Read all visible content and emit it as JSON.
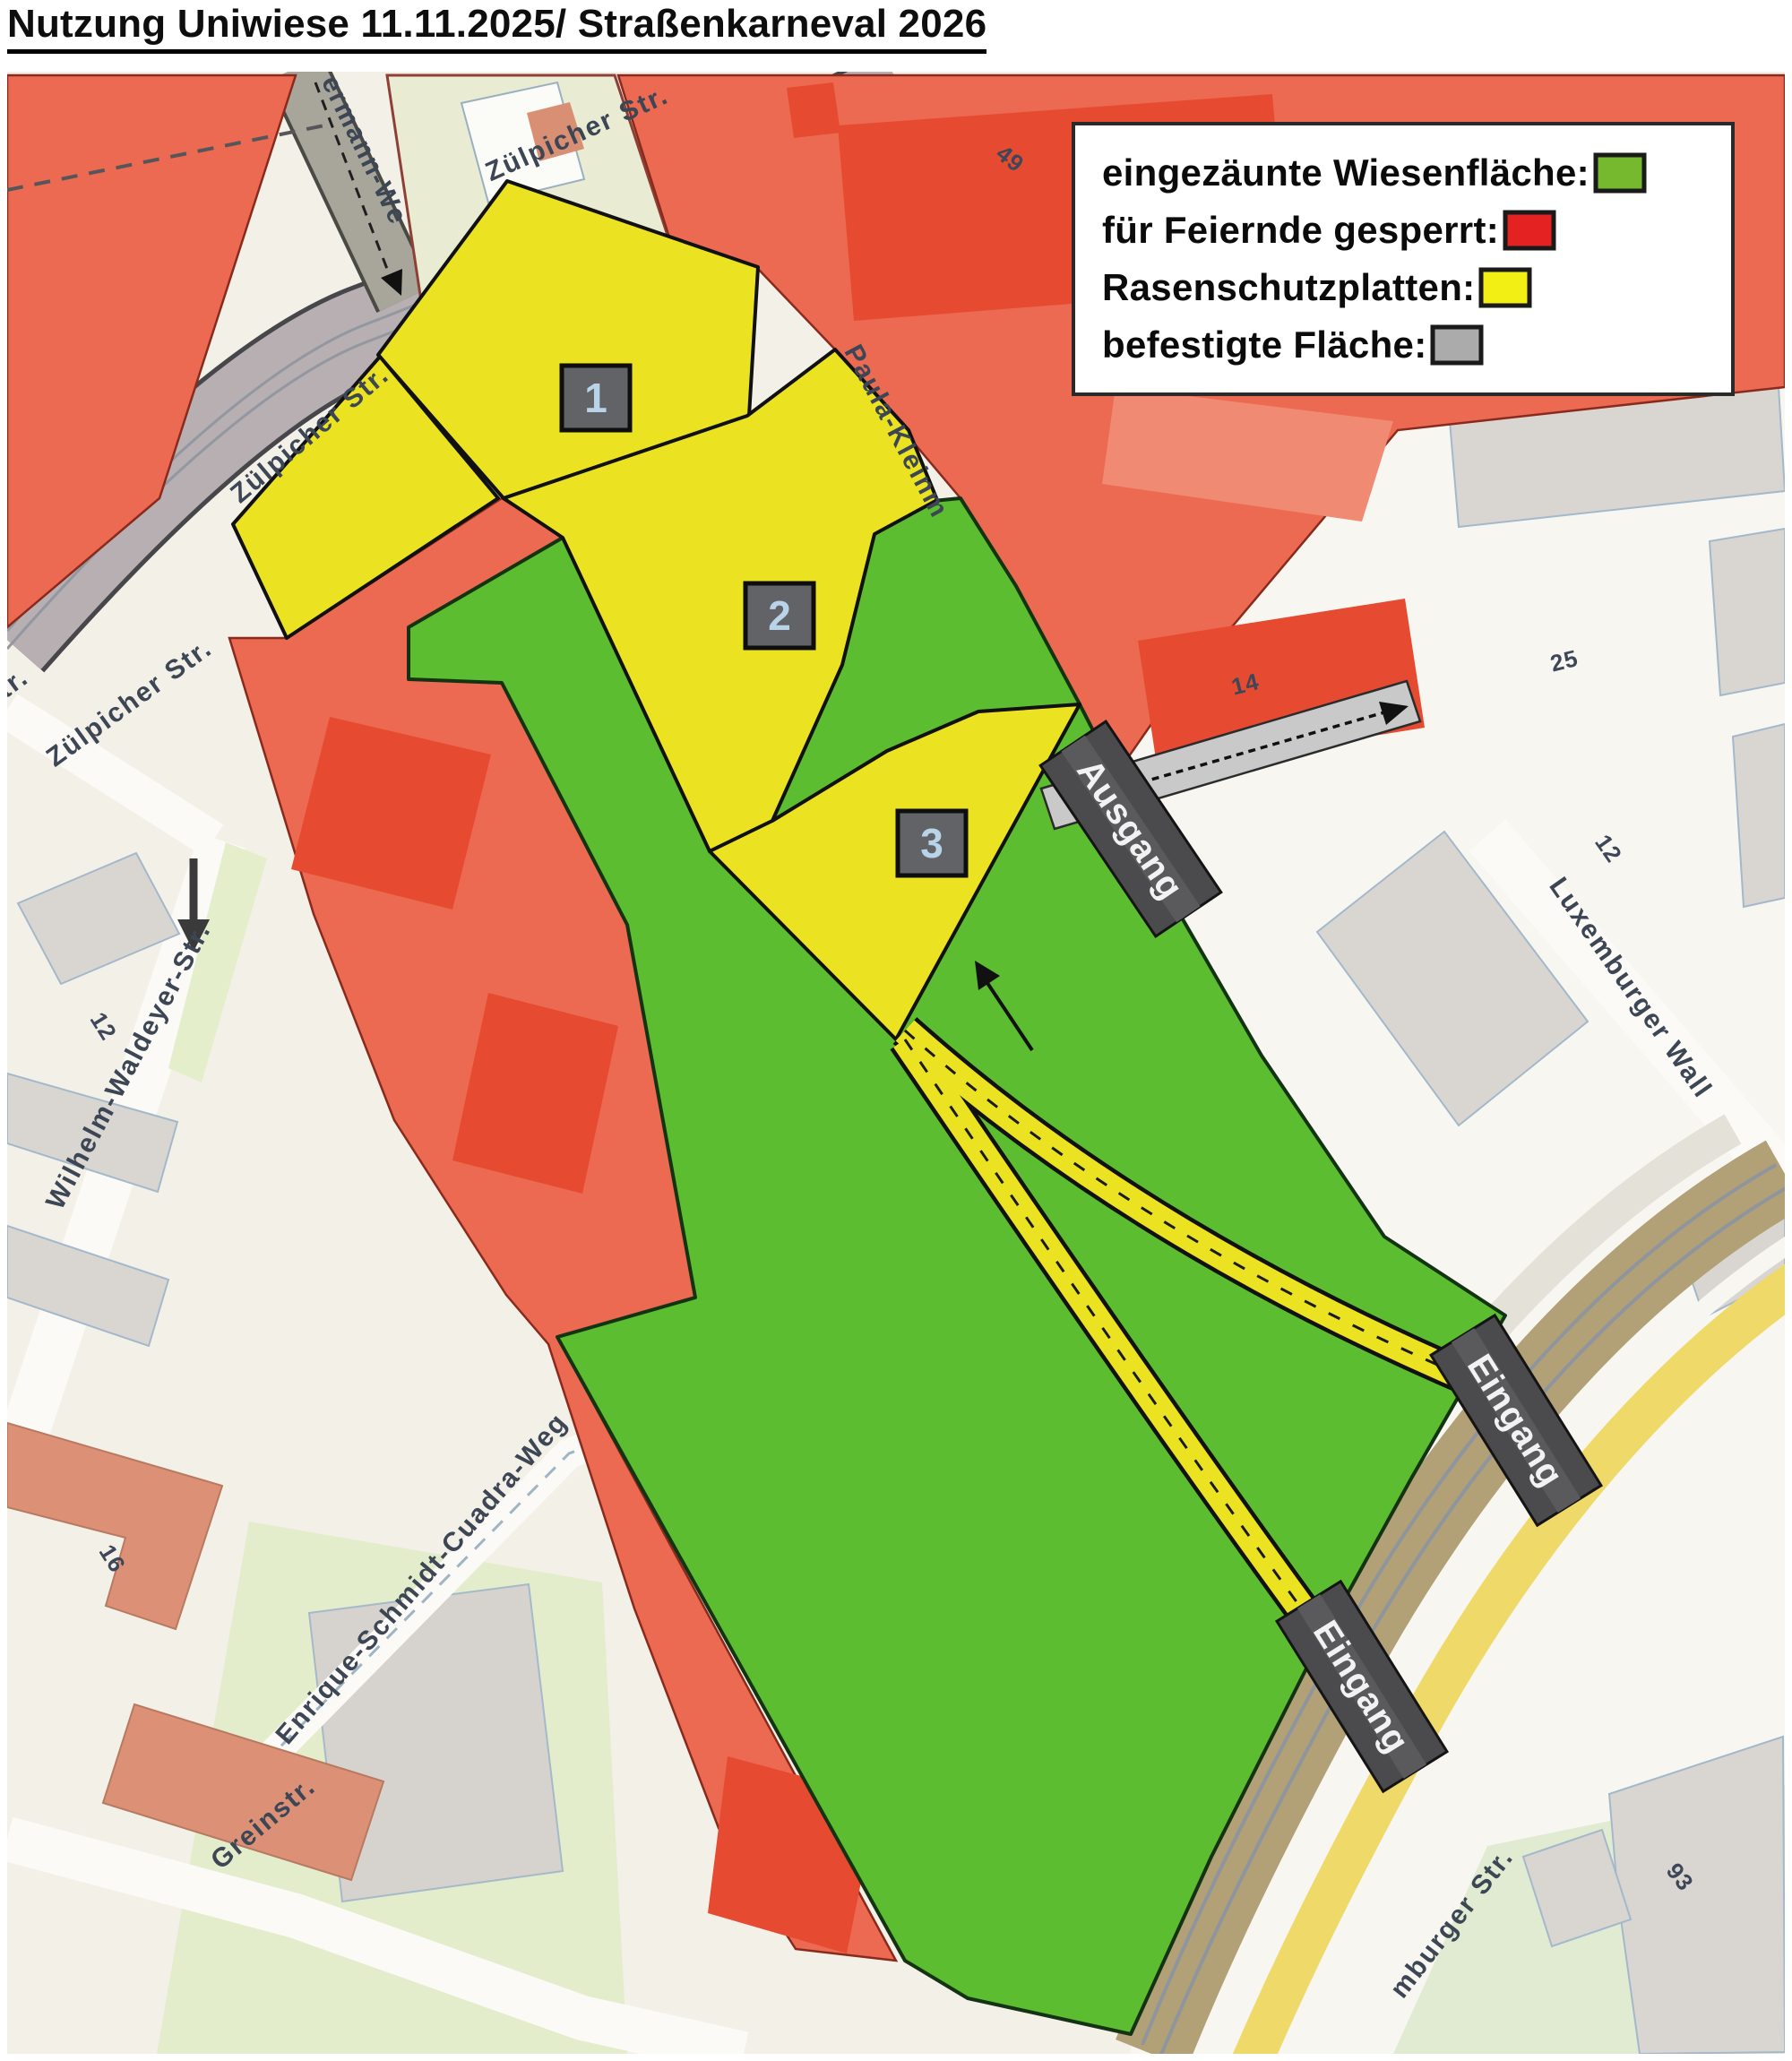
{
  "title": "Nutzung Uniwiese 11.11.2025/ Straßenkarneval 2026",
  "legend": {
    "items": [
      {
        "label": "eingezäunte Wiesenfläche:",
        "color": "#76b92e"
      },
      {
        "label": "für Feiernde gesperrt:",
        "color": "#e52222"
      },
      {
        "label": "Rasenschutzplatten:",
        "color": "#f2ef15"
      },
      {
        "label": "befestigte Fläche:",
        "color": "#ababab"
      }
    ]
  },
  "map": {
    "colors": {
      "green": "#5bbd2f",
      "red": "#eb6a51",
      "yellow": "#ebe322",
      "paved": "#c9c9c9"
    },
    "zone_markers": {
      "zone1": "1",
      "zone2": "2",
      "zone3": "3"
    },
    "gates": {
      "exit": "Ausgang",
      "entrance1": "Eingang",
      "entrance2": "Eingang"
    },
    "streets": {
      "zuelpicher_top": "Zülpicher Str.",
      "zuelpicher_mid": "Zülpicher Str.",
      "zuelpicher_low": "Zülpicher Str.",
      "zuelpicher_partial": "tr.",
      "weg_partial": "ermann-We",
      "paula": "Paula-Kleinm",
      "luxemburger_wall": "Luxemburger Wall",
      "wilhelm": "Wilhelm-Waldeyer-Str.",
      "enrique": "Enrique-Schmidt-Cuadra-Weg",
      "grein": "Greinstr.",
      "luxemburger_str": "mburger Str."
    },
    "house_numbers": {
      "n49": "49",
      "n14": "14",
      "n25": "25",
      "n12_right": "12",
      "n12_left": "12",
      "n16": "16",
      "n93": "93"
    }
  }
}
